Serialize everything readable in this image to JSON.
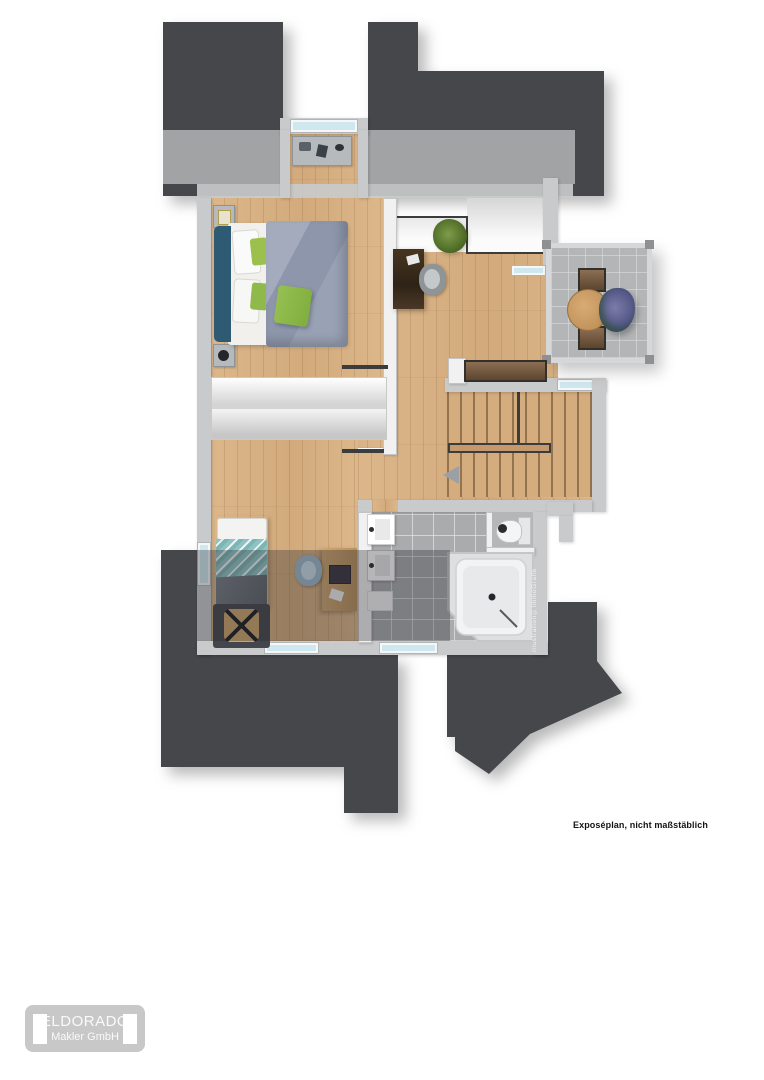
{
  "plan": {
    "caption": "Exposéplan, nicht maßstäblich",
    "watermark": "Illustration©ImmoGrafik"
  },
  "logo": {
    "company": "ELDORADO",
    "subtitle": "Makler GmbH"
  },
  "colors": {
    "roof": "#45464c",
    "outer_wall": "#c9cacb",
    "inner_wall": "#f1f1f1",
    "wood_floor": "#d9b285",
    "bath_tile": "#a9abad",
    "balcony_tile": "#b3b5b7",
    "window_glass": "#cfe8f0",
    "bed_headboard_blue": "#2e5a74",
    "duvet_gray_blue": "#97a0b4",
    "accent_green": "#8fb94a",
    "teal_bedding": "#8fc3c3",
    "dark_outline": "#3c3c3c"
  }
}
